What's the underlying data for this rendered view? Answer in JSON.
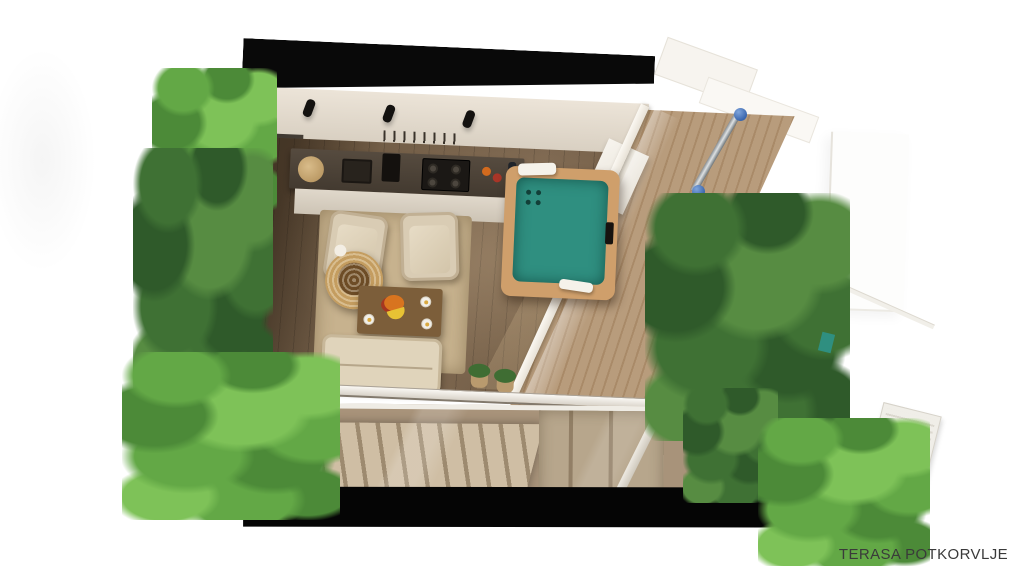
{
  "caption": {
    "text": "TERASA POTKORVLJE"
  },
  "scene": {
    "type": "3d-architectural-render",
    "view": "top-down cutaway of attic terrace apartment",
    "palette": {
      "background": "#ffffff",
      "roof_cut": "#070707",
      "back_wall": "#e6ded2",
      "wood_floor": "#74604a",
      "kitchen_counter": "#4c4237",
      "cabinet": "#d9d1c3",
      "hot_tub_frame": "#cf9f6b",
      "hot_tub_water": "#2f8f80",
      "armchair": "#d9ccb4",
      "sofa": "#e0d4bb",
      "rattan_chair": "#b08344",
      "rug": "#c7b28e",
      "coffee_table": "#7c5e3a",
      "foliage_dark": "#3f7134",
      "foliage_bright": "#7ec258",
      "stair_glass": "#a8937a",
      "stair_steps": "#cfbea4",
      "deck_wood": "#b3977a",
      "railing_cap_blue": "#3a66ad",
      "frame_white": "#f3efe8"
    },
    "objects": [
      "roof-cut-top",
      "back-wall",
      "ceiling-spotlights",
      "utensil-rack",
      "kitchen-counter",
      "sink",
      "gas-hob",
      "knife-block",
      "cutting-board",
      "area-rug",
      "armchair-left",
      "armchair-right",
      "rattan-chair",
      "coffee-table",
      "fruit-bowl",
      "plates",
      "sofa",
      "hot-tub",
      "towels",
      "potted-plants",
      "glass-wall-left",
      "glass-wall-right",
      "terrace-deck",
      "shower-railing",
      "stair-glass-roof",
      "staircase",
      "roof-cut-bottom",
      "bamboo-foliage",
      "planter-boxes",
      "white-wall-panel",
      "teal-wall-art"
    ]
  }
}
